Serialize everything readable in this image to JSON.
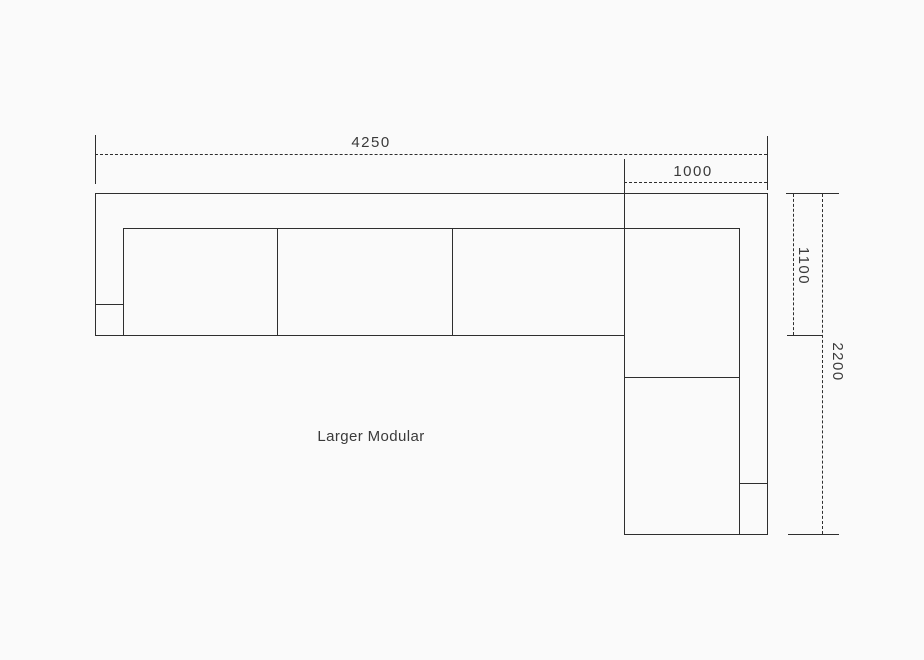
{
  "colors": {
    "line": "#2e2e2e",
    "text": "#3a3a3a",
    "background": "#fafafa"
  },
  "diagram": {
    "product_label": "Larger Modular",
    "dimensions": {
      "total_width": "4250",
      "corner_section_width": "1000",
      "seat_depth": "1100",
      "total_depth": "2200"
    }
  }
}
